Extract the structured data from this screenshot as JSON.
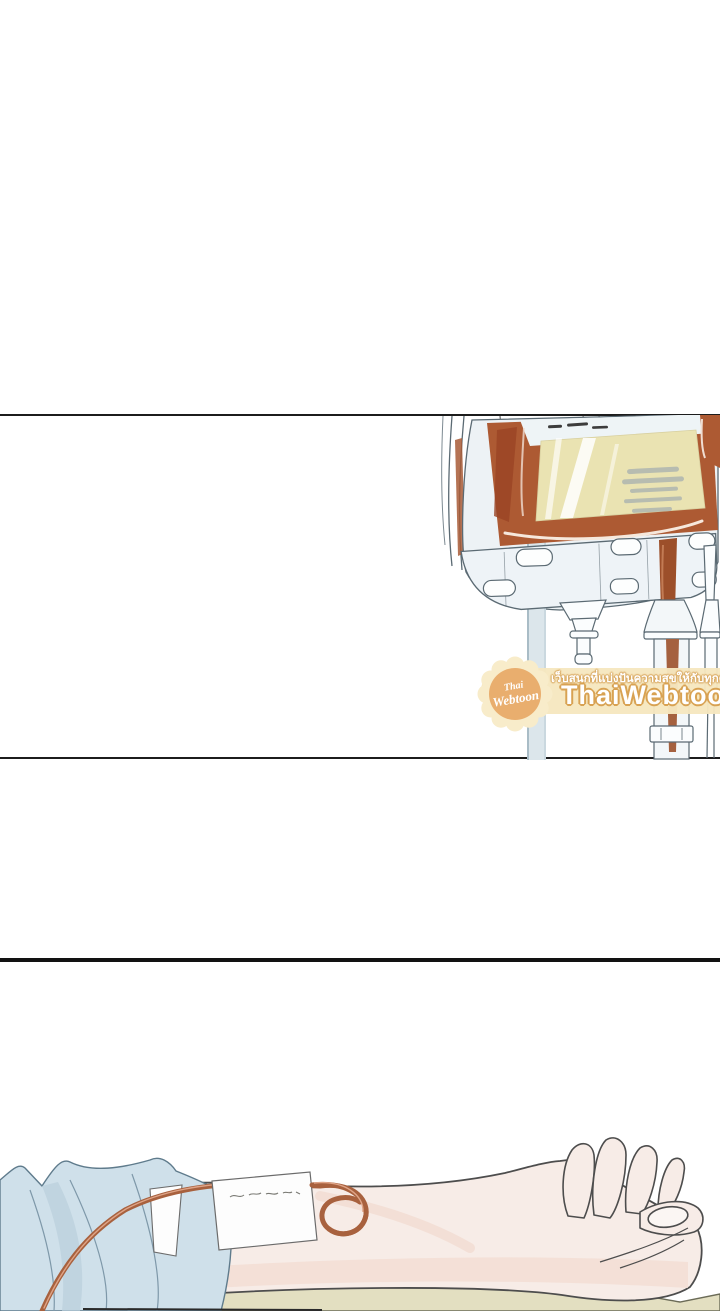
{
  "page": {
    "width": 720,
    "height": 1311,
    "background": "#ffffff",
    "kind": "webtoon-comic-page"
  },
  "panels": {
    "divider_color": "#1c1c1c",
    "divider_y_positions": [
      414,
      757,
      958
    ]
  },
  "watermark": {
    "site_name": "ThaiWebtoon",
    "tagline": "เว็บสนุกที่แบ่งปันความสุขให้กับทุกคน",
    "badge_line1": "Thai",
    "badge_line2": "Webtoon",
    "band_color": "#f6e7bf",
    "badge_color": "#e9ae6e",
    "text_color": "#ffffff",
    "outline_color": "#d8a253"
  },
  "artwork": {
    "top_panel_subject": "blood transfusion bag with drip chamber on IV stand",
    "bottom_panel_subject": "patient arm with IV line taped to forearm resting on bed",
    "colors": {
      "blood": "#ad5a33",
      "blood_dark": "#9a4424",
      "bag_label": "#eae3b2",
      "plastic": "#edf2f5",
      "pole": "#dce6eb",
      "outline": "#4d4d4d",
      "tube": "#a8613e",
      "skin": "#f7ece7",
      "skin_shade": "#f3ddd3",
      "fabric": "#cfe0ea",
      "fabric_shade": "#b9cfdc",
      "bed": "#e3dfc1"
    }
  }
}
